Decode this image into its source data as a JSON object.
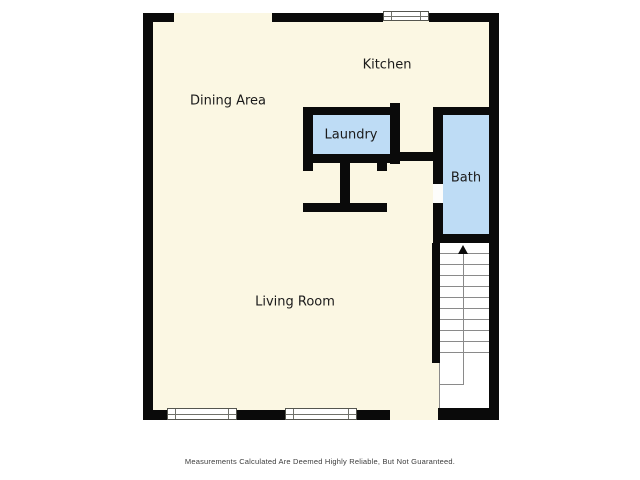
{
  "rooms": [
    {
      "id": "kitchen",
      "label": "Kitchen",
      "floor": "cream"
    },
    {
      "id": "dining-area",
      "label": "Dining Area",
      "floor": "cream"
    },
    {
      "id": "laundry",
      "label": "Laundry",
      "floor": "blue"
    },
    {
      "id": "bath",
      "label": "Bath",
      "floor": "blue"
    },
    {
      "id": "living-room",
      "label": "Living Room",
      "floor": "cream"
    }
  ],
  "stairs": {
    "direction": "up",
    "tread_count": 10
  },
  "disclaimer": "Measurements Calculated Are Deemed Highly Reliable, But Not Guaranteed.",
  "colors": {
    "background": "#ffffff",
    "floor": "#fbf7e3",
    "wall": "#0a0a0a",
    "room_highlight": "#bedcf5",
    "stair_lines": "#8a8a8a",
    "text": "#1a1a1a"
  }
}
